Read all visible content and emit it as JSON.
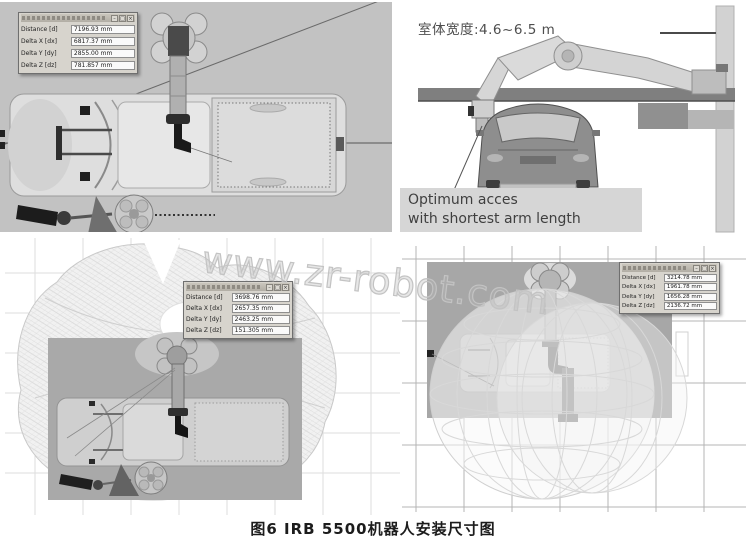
{
  "watermark": "www.zr-robot.com",
  "caption": "图6  IRB 5500机器人安装尺寸图",
  "dialog_chrome": {
    "minimize": "–",
    "maximize": "□",
    "close": "×"
  },
  "colors": {
    "panel_gray": "#c2c2c2",
    "viewport_gray": "#a9a9a9",
    "callout_bg": "#d6d6d6",
    "grid_light": "#dedede",
    "grid_dark": "#b4b4b4"
  },
  "panels": {
    "top_left": {
      "dialog": {
        "rows": [
          {
            "label": "Distance [d]",
            "value": "7196.93 mm"
          },
          {
            "label": "Delta X [dx]",
            "value": "6817.37 mm"
          },
          {
            "label": "Delta Y [dy]",
            "value": "2855.00 mm"
          },
          {
            "label": "Delta Z [dz]",
            "value": "781.857 mm"
          }
        ]
      }
    },
    "top_right": {
      "width_label": "室体宽度:4.6~6.5 m",
      "callout_line1": "Optimum acces",
      "callout_line2": "with shortest arm length"
    },
    "bottom_left": {
      "dialog": {
        "rows": [
          {
            "label": "Distance [d]",
            "value": "3698.76 mm"
          },
          {
            "label": "Delta X [dx]",
            "value": "2657.35 mm"
          },
          {
            "label": "Delta Y [dy]",
            "value": "2463.25 mm"
          },
          {
            "label": "Delta Z [dz]",
            "value": "151.305 mm"
          }
        ]
      }
    },
    "bottom_right": {
      "dialog": {
        "rows": [
          {
            "label": "Distance [d]",
            "value": "3214.78 mm"
          },
          {
            "label": "Delta X [dx]",
            "value": "1961.78 mm"
          },
          {
            "label": "Delta Y [dy]",
            "value": "1656.28 mm"
          },
          {
            "label": "Delta Z [dz]",
            "value": "2136.72 mm"
          }
        ]
      }
    }
  }
}
